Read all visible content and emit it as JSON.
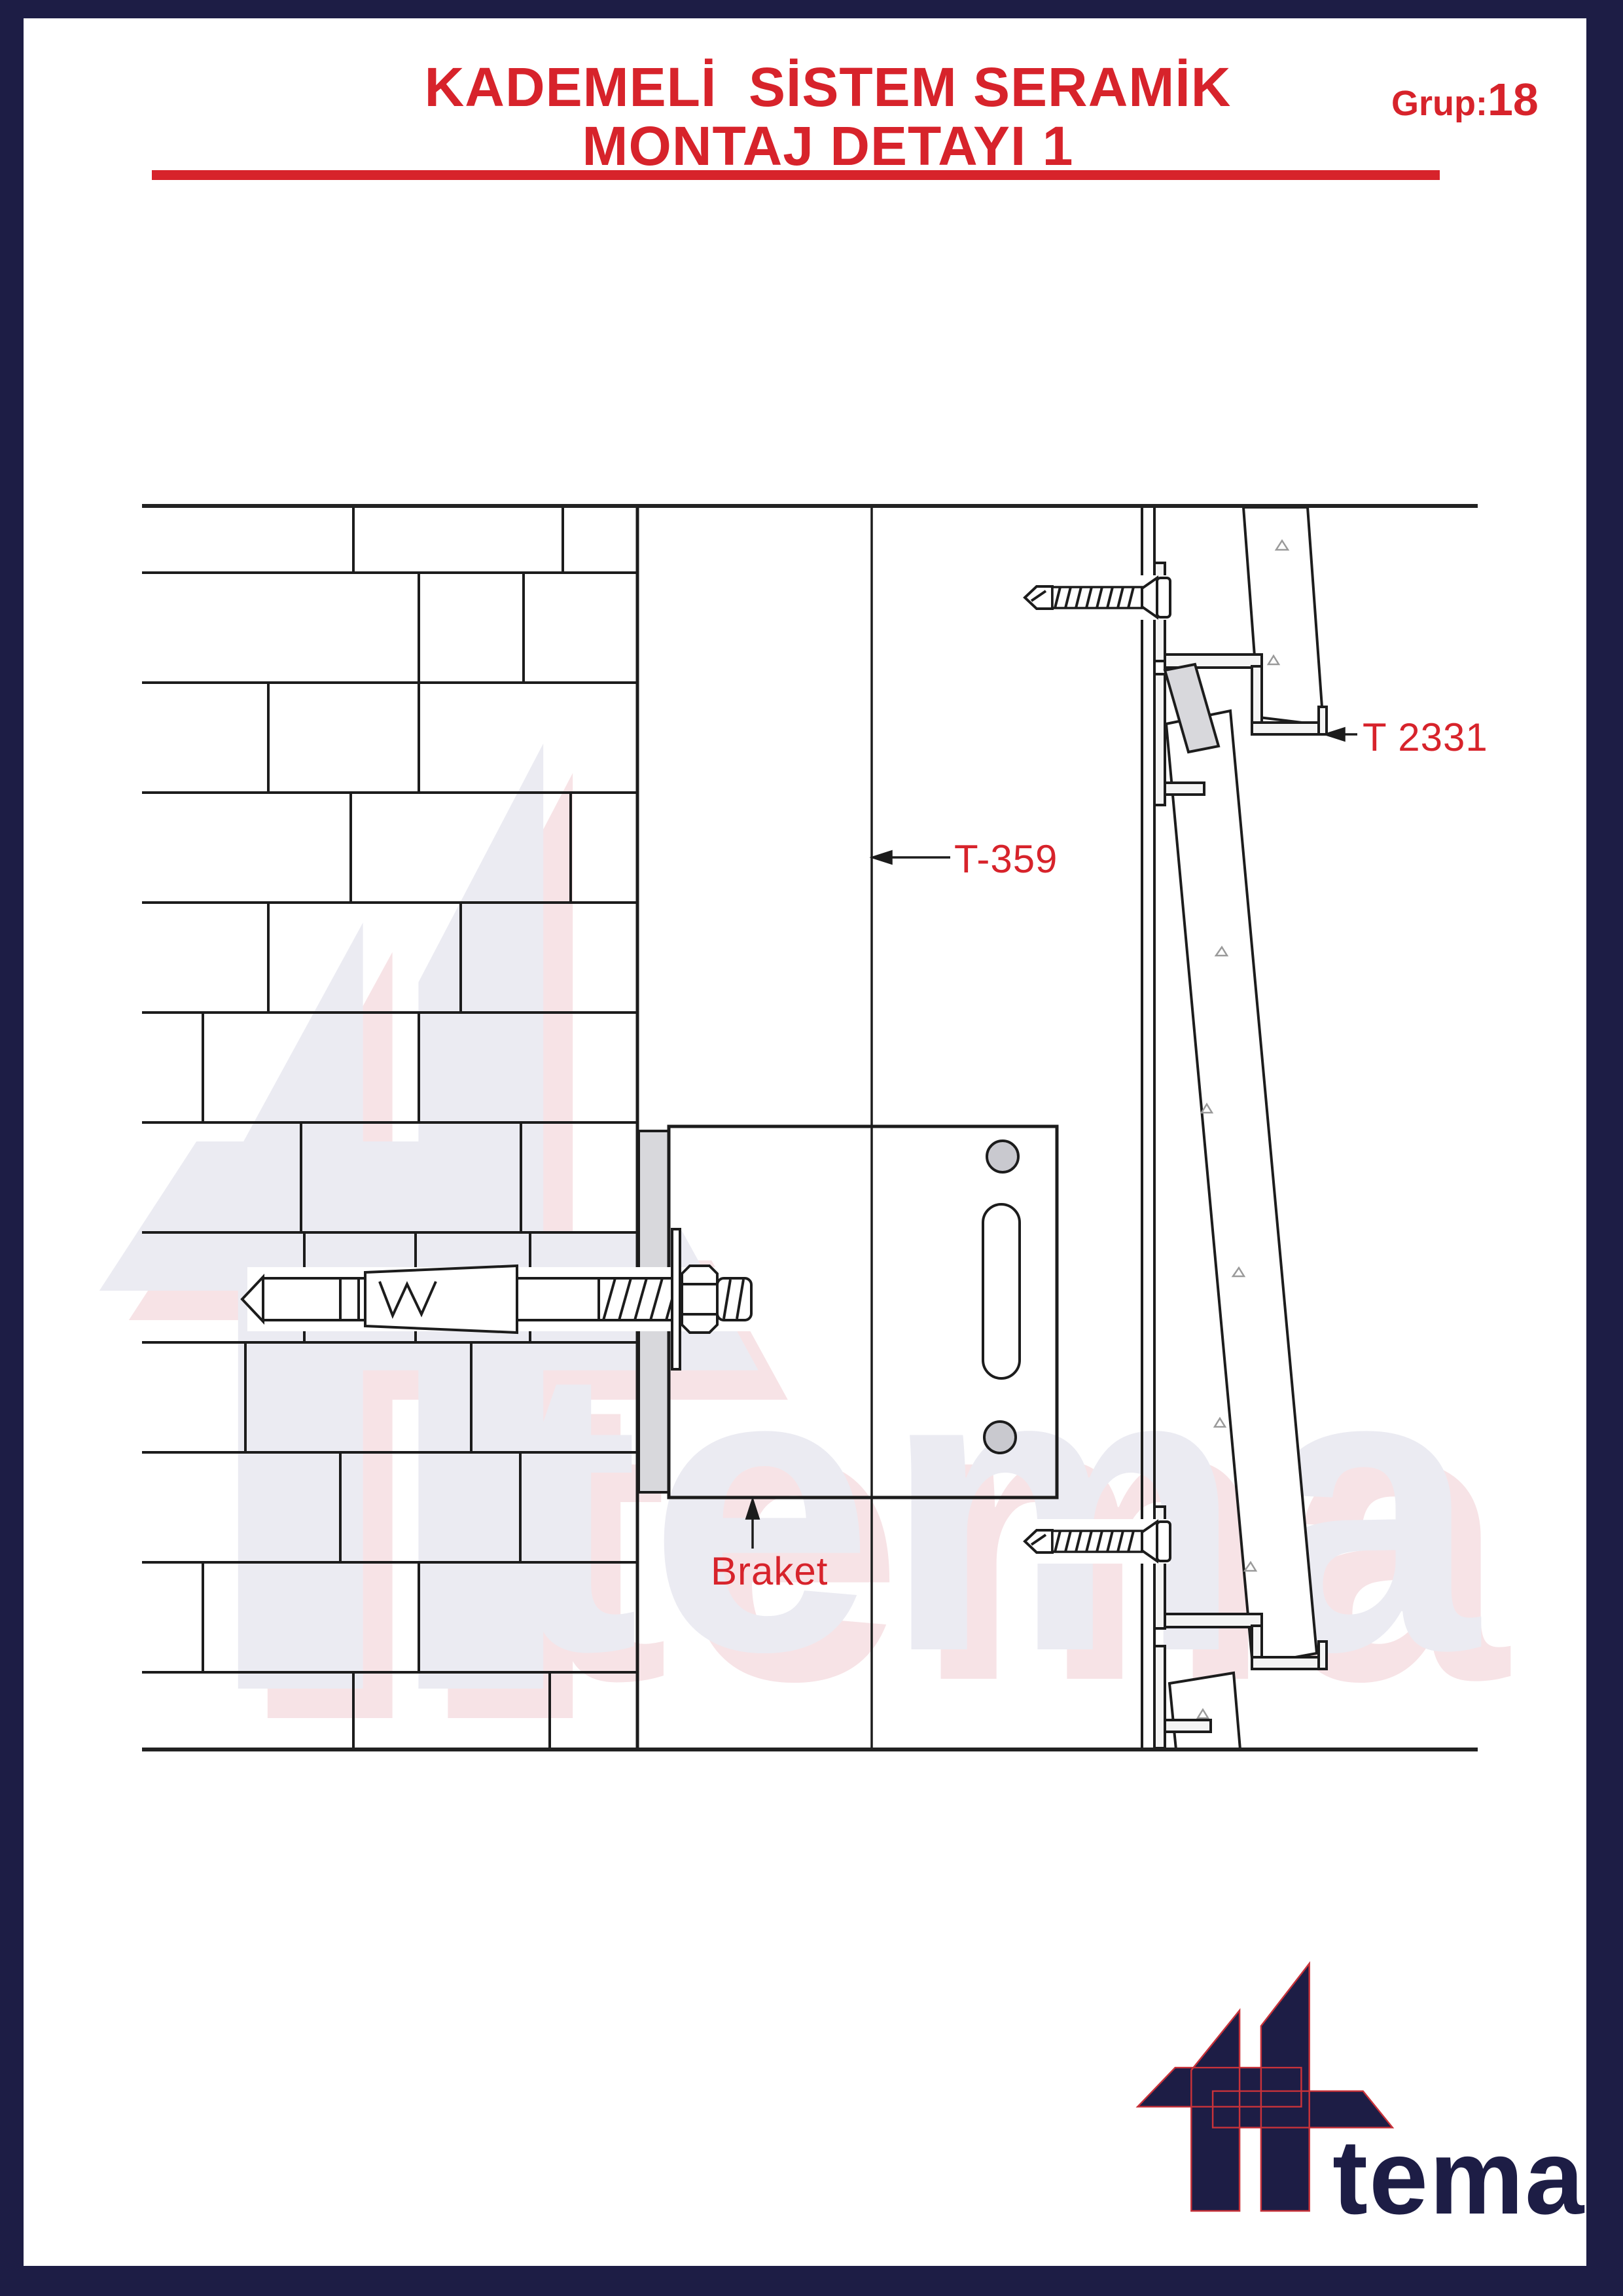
{
  "header": {
    "title_line1": "KADEMELİ  SİSTEM SERAMİK",
    "title_line2": "MONTAJ DETAYI 1",
    "group_label": "Grup:",
    "group_number": "18"
  },
  "drawing": {
    "labels": {
      "t2331": "T 2331",
      "t359": "T-359",
      "braket": "Braket"
    }
  },
  "watermark": {
    "text": "tema"
  },
  "logo": {
    "text": "tema"
  },
  "icons": [
    "tema-logo",
    "tema-logo-watermark",
    "leader-arrow-icon"
  ],
  "colors": {
    "accent_red": "#d7232b",
    "frame_navy": "#1d1d45",
    "line_black": "#1c1c1c",
    "watermark_gray": "#ebebf2",
    "watermark_pink": "#f7e3e6",
    "metal_gray": "#d8d8dc",
    "hole_gray": "#c9c9cf"
  }
}
